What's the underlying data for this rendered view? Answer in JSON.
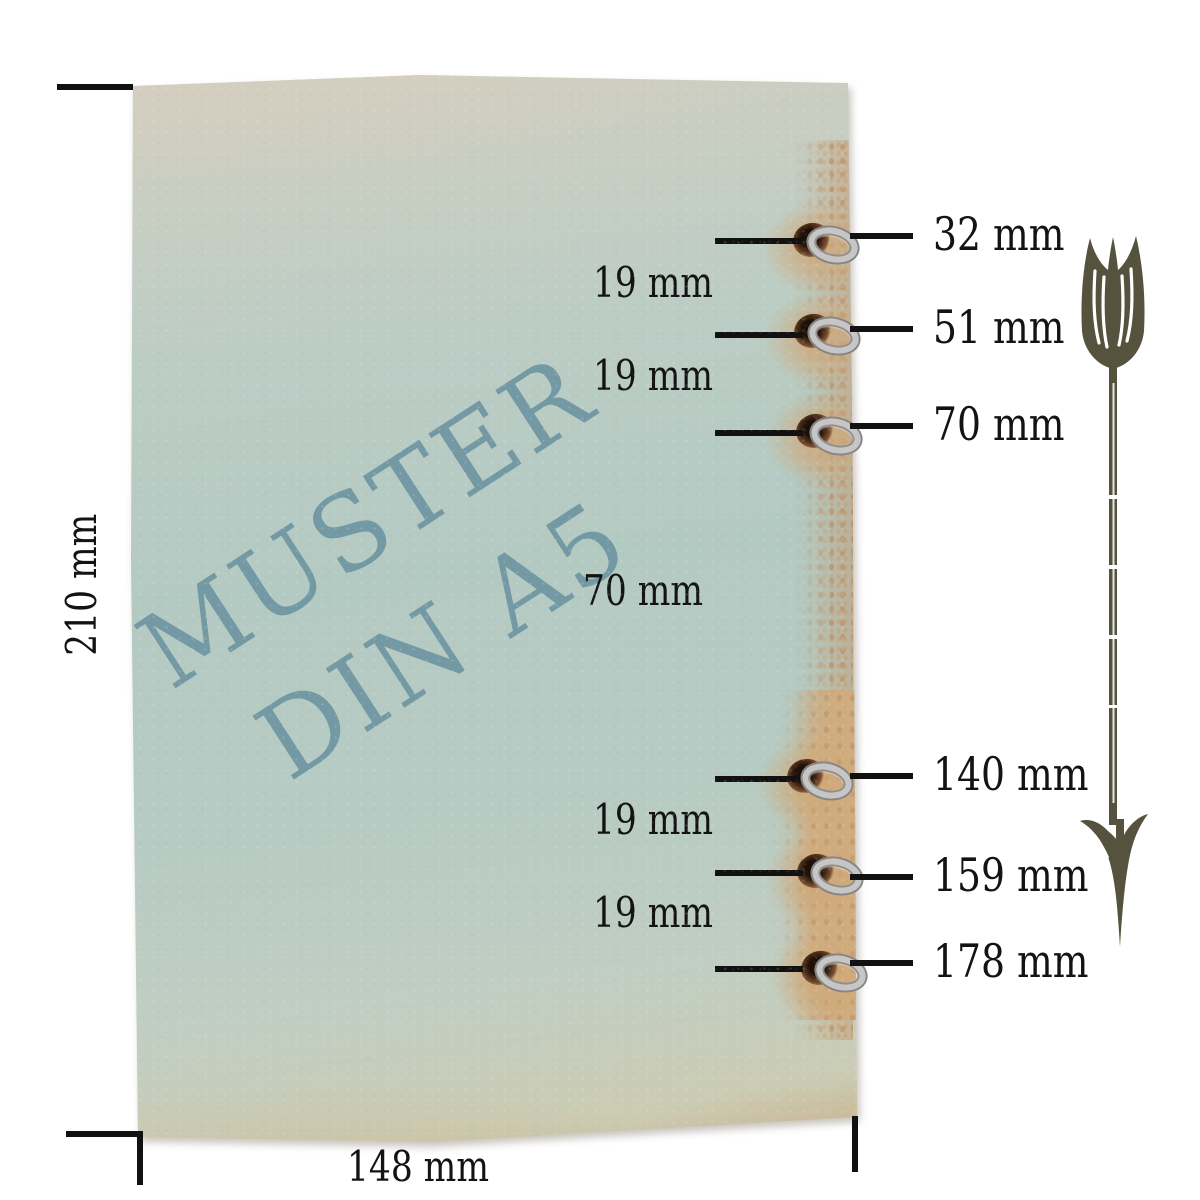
{
  "paper": {
    "watermark": {
      "line1": "MUSTER",
      "line2": "DIN A5",
      "color": "#6d95a2"
    }
  },
  "dimensions": {
    "height_label": "210 mm",
    "width_label": "148 mm"
  },
  "holes": [
    {
      "position_label": "32 mm"
    },
    {
      "position_label": "51 mm"
    },
    {
      "position_label": "70 mm"
    },
    {
      "position_label": "140 mm"
    },
    {
      "position_label": "159 mm"
    },
    {
      "position_label": "178 mm"
    }
  ],
  "gaps": [
    {
      "label": "19 mm"
    },
    {
      "label": "19 mm"
    },
    {
      "label": "70 mm"
    },
    {
      "label": "19 mm"
    },
    {
      "label": "19 mm"
    }
  ],
  "icons": {
    "arrow_ornament": "feathered-down-arrow"
  },
  "colors": {
    "ink": "#131313",
    "arrow": "#55523e",
    "paper_green": "#b5cbc4",
    "paper_tan": "#d6cfc0",
    "rust": "#c08a58",
    "watermark": "#6d95a2",
    "silver": "#c6c6c6",
    "hole_brown": "#4a2c18",
    "background": "#ffffff"
  }
}
